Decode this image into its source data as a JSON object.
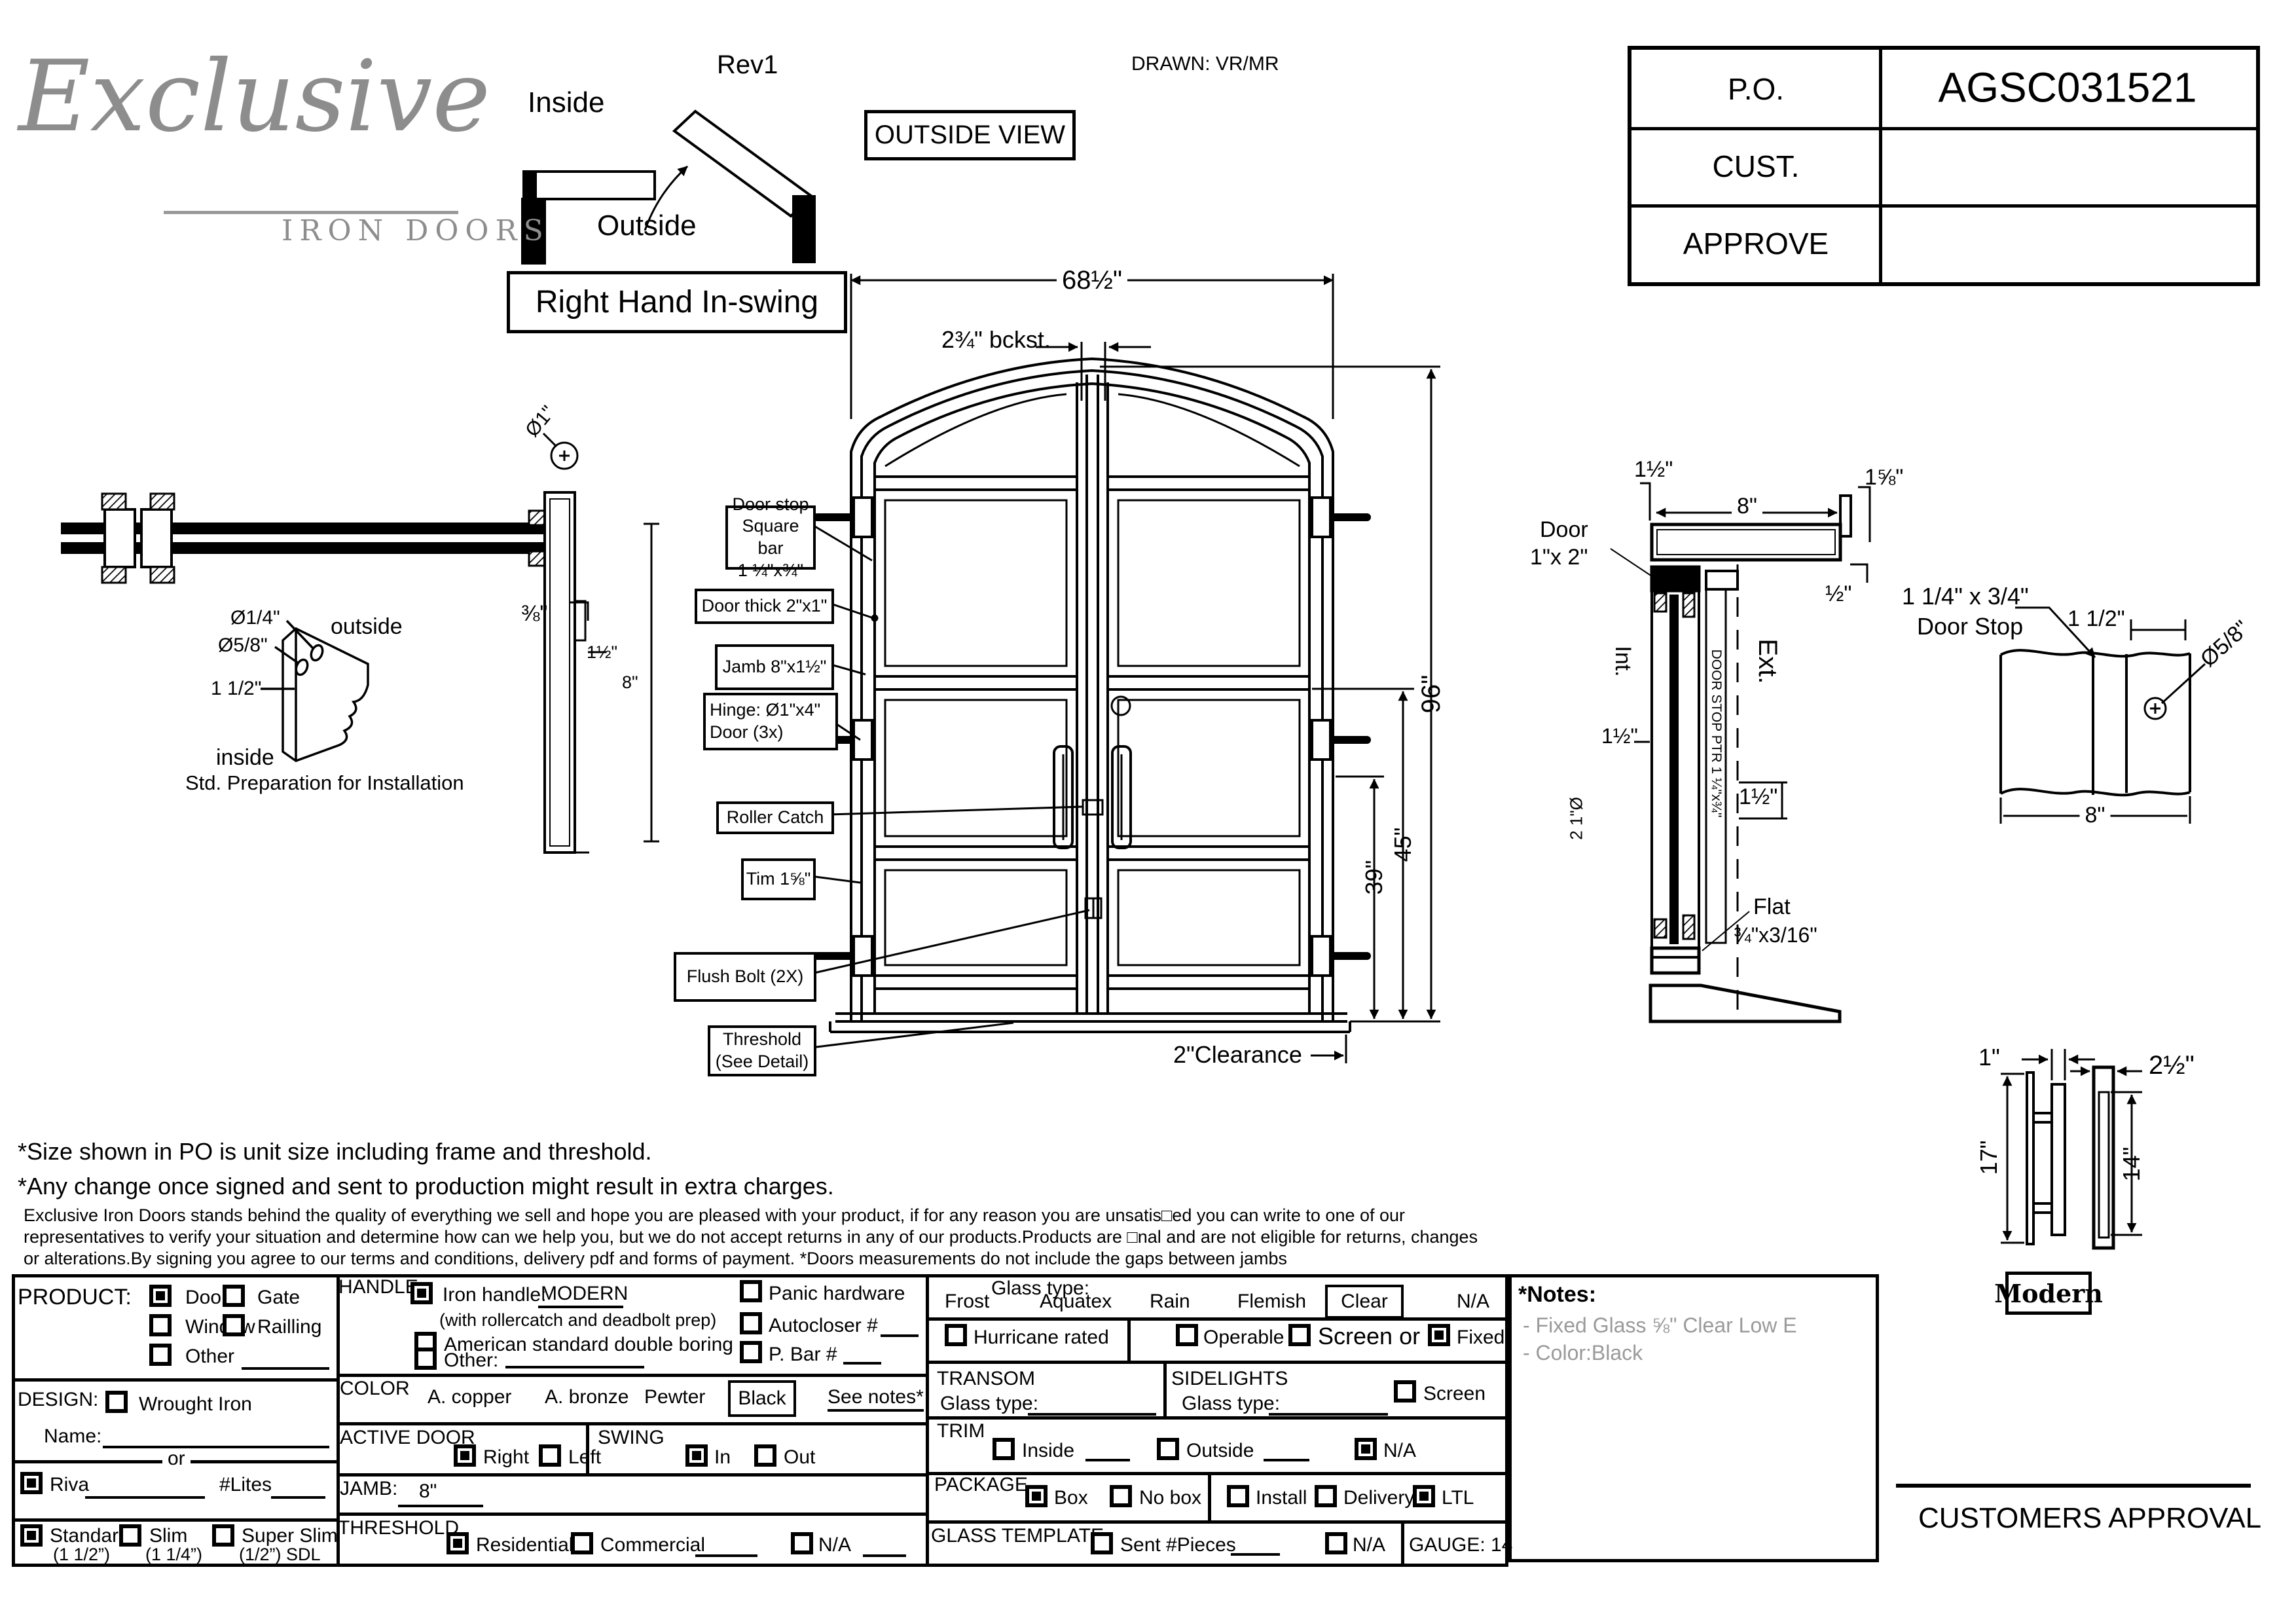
{
  "header": {
    "logo_script": "Exclusive",
    "logo_sub": "IRON DOORS",
    "rev": "Rev1",
    "inside": "Inside",
    "outside": "Outside",
    "outside_view": "OUTSIDE VIEW",
    "drawn": "DRAWN: VR/MR",
    "swing_title": "Right Hand In-swing",
    "po": {
      "po_label": "P.O.",
      "po_value": "AGSC031521",
      "cust_label": "CUST.",
      "cust_value": "",
      "approve_label": "APPROVE",
      "approve_value": ""
    }
  },
  "elevation": {
    "width": "68½\"",
    "backset": "2¾\" bckst.",
    "height": "96\"",
    "lock_height": "45\"",
    "dim39": "39\"",
    "clearance": "2\"Clearance",
    "callout_doorstop_1": "Door stop",
    "callout_doorstop_2": "Square bar",
    "callout_doorstop_3": "1 ¼\"x¾\"",
    "callout_thick": "Door thick 2\"x1\"",
    "callout_jamb": "Jamb 8\"x1½\"",
    "callout_hinge_1": "Hinge: Ø1\"x4\"",
    "callout_hinge_2": "Door (3x)",
    "callout_roller": "Roller Catch",
    "callout_trim": "Tim 1⅝\"",
    "callout_flush": "Flush Bolt (2X)",
    "callout_threshold_1": "Threshold",
    "callout_threshold_2": "(See Detail)"
  },
  "wall_section": {
    "dia1": "Ø1\"",
    "d38": "⅜\"",
    "d112": "1½\"",
    "d8": "8\""
  },
  "prep": {
    "dia14": "Ø1/4\"",
    "dia58": "Ø5/8\"",
    "d112": "1 1/2\"",
    "outside": "outside",
    "inside": "inside",
    "caption": "Std. Preparation for Installation"
  },
  "jamb_section": {
    "d112": "1½\"",
    "d8": "8\"",
    "d158": "1⅝\"",
    "d12": "½\"",
    "door_l1": "Door",
    "door_l2": "1\"x 2\"",
    "int": "Int.",
    "ext": "Ext.",
    "stop_vert": "DOOR STOP PTR 1 ¼\"x¾\"",
    "d112b": "1½\"",
    "d112c": "1½\"",
    "tube": "2  1\"Ø",
    "flat": "Flat",
    "flat_size": "¾\"x3/16\""
  },
  "doorstop_detail": {
    "size": "1 1/4\" x 3/4\"",
    "name": "Door Stop",
    "d112": "1 1/2\"",
    "dia58": "Ø5/8\"",
    "d8": "8\""
  },
  "handle_detail": {
    "d1": "1\"",
    "d212": "2½\"",
    "d17": "17\"",
    "d14": "14\"",
    "name": "Modern"
  },
  "notes": {
    "line1": "*Size shown in PO is unit size including frame and threshold.",
    "line2": "*Any change once signed and sent to production might result in extra charges.",
    "fine1": "Exclusive Iron Doors stands behind the quality of everything we sell and hope you are pleased with your product, if for any reason you are unsatis□ed you can write to one of our",
    "fine2": "representatives to verify your situation and determine how can we help you, but we do not accept returns in any of our products.Products are □nal and are not eligible for returns, changes",
    "fine3": "or alterations.By signing you agree to our terms and conditions, delivery pdf and forms of payment. *Doors measurements do not include the gaps between jambs"
  },
  "form": {
    "product": {
      "label": "PRODUCT:",
      "door": {
        "label": "Door",
        "checked": true
      },
      "gate": {
        "label": "Gate",
        "checked": false
      },
      "window": {
        "label": "Window",
        "checked": false
      },
      "railling": {
        "label": "Railling",
        "checked": false
      },
      "other": {
        "label": "Other",
        "checked": false
      }
    },
    "design": {
      "label": "DESIGN:",
      "wrought": {
        "label": "Wrought Iron",
        "checked": false
      },
      "name_label": "Name:",
      "or_label": "or",
      "riva": {
        "label": "Riva",
        "checked": true
      },
      "lites_label": "#Lites",
      "standard": {
        "label": "Standard",
        "sub": "(1 1/2”)",
        "checked": true
      },
      "slim": {
        "label": "Slim",
        "sub": "(1 1/4”)",
        "checked": false
      },
      "superslim": {
        "label": "Super Slim",
        "sub": "(1/2”) SDL",
        "checked": false
      }
    },
    "handle": {
      "label": "HANDLE",
      "iron": {
        "label": "Iron handle:",
        "value": "MODERN",
        "sub": "(with rollercatch and deadbolt prep)",
        "checked": true
      },
      "american": {
        "label": "American standard double boring",
        "checked": false
      },
      "other": {
        "label": "Other:",
        "checked": false
      },
      "panic": {
        "label": "Panic hardware",
        "checked": false
      },
      "autocloser": {
        "label": "Autocloser #",
        "checked": false
      },
      "pbar": {
        "label": "P. Bar #",
        "checked": false
      }
    },
    "color": {
      "label": "COLOR",
      "copper": "A. copper",
      "bronze": "A. bronze",
      "pewter": "Pewter",
      "black": "Black",
      "see_notes": "See notes*"
    },
    "active_door": {
      "label": "ACTIVE DOOR",
      "right": {
        "label": "Right",
        "checked": true
      },
      "left": {
        "label": "Left",
        "checked": false
      }
    },
    "swing": {
      "label": "SWING",
      "in": {
        "label": "In",
        "checked": true
      },
      "out": {
        "label": "Out",
        "checked": false
      }
    },
    "jamb": {
      "label": "JAMB:",
      "value": "8\""
    },
    "threshold": {
      "label": "THRESHOLD",
      "residential": {
        "label": "Residential",
        "checked": true
      },
      "commercial": {
        "label": "Commercial",
        "checked": false
      },
      "na": {
        "label": "N/A",
        "checked": false
      }
    },
    "glass": {
      "label": "Glass type:",
      "frost": "Frost",
      "aquatex": "Aquatex",
      "rain": "Rain",
      "flemish": "Flemish",
      "clear": "Clear",
      "na": "N/A",
      "hurricane": {
        "label": "Hurricane rated",
        "checked": false
      },
      "operable": {
        "label": "Operable",
        "checked": false
      },
      "screen_or": {
        "label": "Screen or",
        "checked": false
      },
      "fixed": {
        "label": "Fixed",
        "checked": true
      }
    },
    "transom": {
      "label": "TRANSOM",
      "glass_label": "Glass type:"
    },
    "sidelights": {
      "label": "SIDELIGHTS",
      "glass_label": "Glass type:",
      "screen": {
        "label": "Screen",
        "checked": false
      }
    },
    "trim": {
      "label": "TRIM",
      "inside": {
        "label": "Inside",
        "checked": false
      },
      "outside": {
        "label": "Outside",
        "checked": false
      },
      "na": {
        "label": "N/A",
        "checked": true
      }
    },
    "package": {
      "label": "PACKAGE",
      "box": {
        "label": "Box",
        "checked": true
      },
      "nobox": {
        "label": "No box",
        "checked": false
      },
      "install": {
        "label": "Install",
        "checked": false
      },
      "delivery": {
        "label": "Delivery",
        "checked": false
      },
      "ltl": {
        "label": "LTL",
        "checked": true
      }
    },
    "glass_template": {
      "label": "GLASS TEMPLATE",
      "sent": {
        "label": "Sent #Pieces",
        "checked": false
      },
      "na": {
        "label": "N/A",
        "checked": false
      }
    },
    "gauge": "GAUGE: 14"
  },
  "side_notes": {
    "title": "*Notes:",
    "n1": "- Fixed Glass ⅝\" Clear  Low E",
    "n2": "- Color:Black"
  },
  "approval": "CUSTOMERS APPROVAL"
}
